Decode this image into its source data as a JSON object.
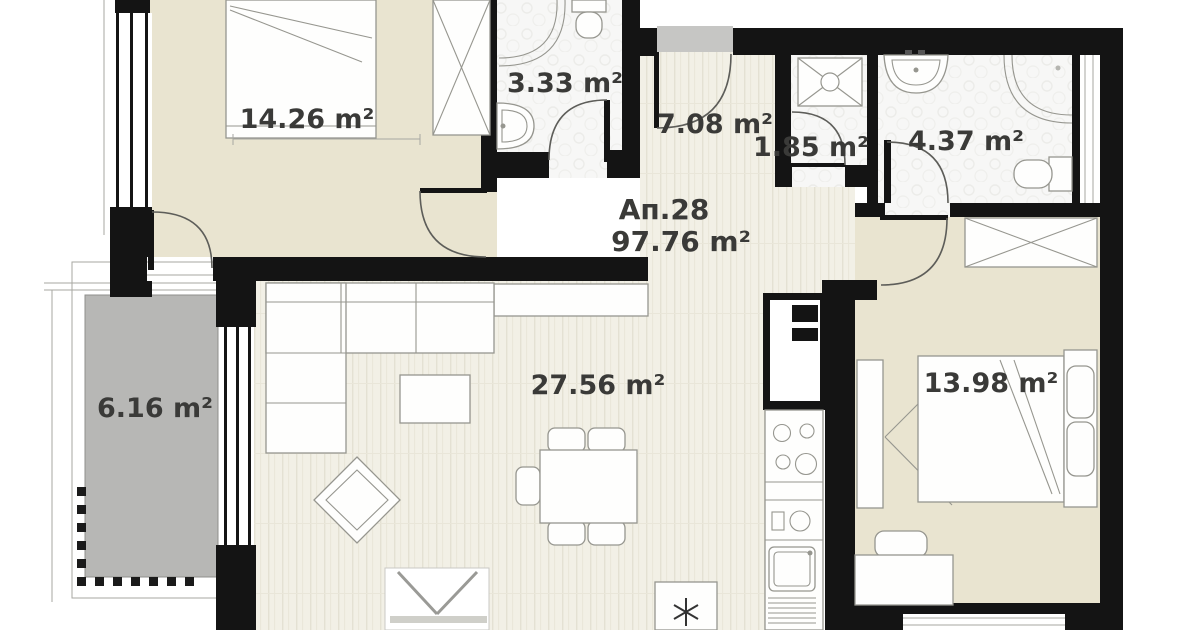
{
  "plan": {
    "apartment": {
      "number_label": "Ап.28",
      "total_area_label": "97.76 m²"
    },
    "rooms": [
      {
        "name": "bedroom-1",
        "area_label": "14.26 m²"
      },
      {
        "name": "bathroom-1",
        "area_label": "3.33 m²"
      },
      {
        "name": "hallway",
        "area_label": "7.08 m²"
      },
      {
        "name": "wc",
        "area_label": "1.85 m²"
      },
      {
        "name": "bathroom-2",
        "area_label": "4.37 m²"
      },
      {
        "name": "living-room-kitchen",
        "area_label": "27.56 m²"
      },
      {
        "name": "bedroom-2",
        "area_label": "13.98 m²"
      },
      {
        "name": "balcony",
        "area_label": "6.16 m²"
      }
    ],
    "icons": {
      "fridge": "snowflake-asterisk"
    },
    "colors": {
      "wall": "#141414",
      "floor_wood": "#f2f0e6",
      "floor_cream": "#e9e4d0",
      "floor_bath": "#f7f7f6",
      "balcony_floor": "#b7b7b5",
      "entrance_landing": "#c6c6c4",
      "label_text": "#3a3a38"
    }
  }
}
